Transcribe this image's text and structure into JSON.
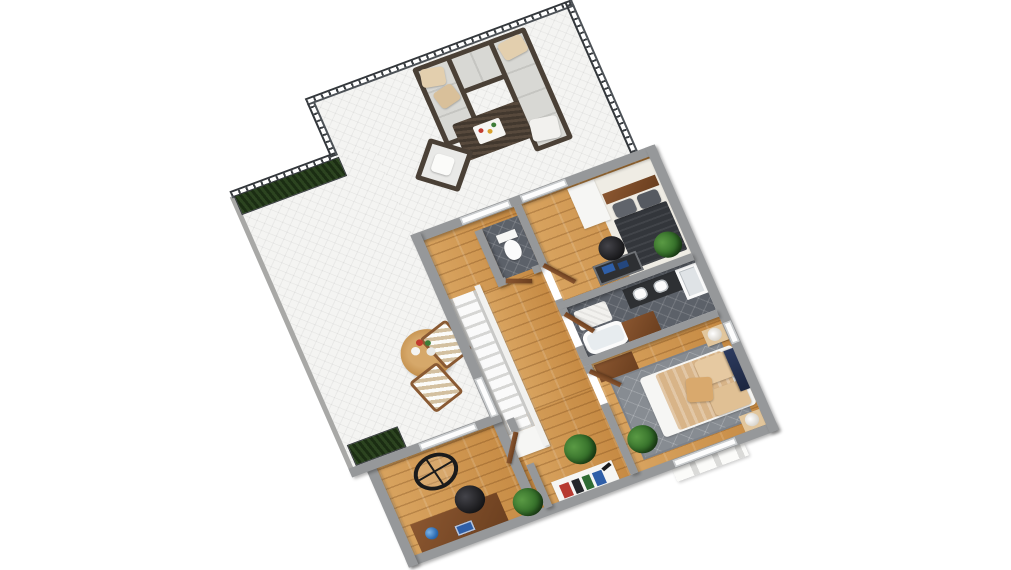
{
  "image": {
    "kind": "3D floor plan rendering, top-down isometric view rotated about 20 degrees",
    "background": "#ffffff",
    "no_text_visible": true
  },
  "terrace": {
    "name": "Terrace",
    "floor": "white herringbone tile",
    "features": [
      "dark metal baluster railing on upper and right edges",
      "hedge planter box along upper-left railing",
      "hedge planter at lower-left corner"
    ],
    "furniture": [
      "dark wicker U-shaped sectional sofa with light gray cushions and beige/white pillows",
      "dark wicker coffee table with white serving tray",
      "dark wicker armchair with white cushion",
      "round wooden dining table with tableware",
      "two striped wooden lounge chairs"
    ]
  },
  "rooms": [
    {
      "name": "Bedroom 1",
      "floor": "wood plank",
      "furniture": [
        "double bed with dark charcoal duvet, gray pillows and wood headboard",
        "white area rug",
        "white wardrobe",
        "dark desk with blue books",
        "black office chair",
        "potted plant"
      ],
      "window": "terrace-facing window"
    },
    {
      "name": "WC",
      "floor": "dark tile",
      "furniture": [
        "white toilet"
      ]
    },
    {
      "name": "Staircase",
      "features": [
        "straight white stairs",
        "white lower landing"
      ]
    },
    {
      "name": "Bathroom",
      "floor": "dark diamond tile",
      "furniture": [
        "white bathtub",
        "white bath mat",
        "wooden cabinet",
        "dark vanity with white sinks",
        "corner shower"
      ]
    },
    {
      "name": "Master Bedroom",
      "floor": "wood plank",
      "furniture": [
        "double bed with striped beige duvet and beige pillows",
        "two beige nightstands with round table lamps",
        "dark blue wall art",
        "gray patterned area rug",
        "wooden dresser",
        "potted plant"
      ],
      "window": "south window with white exterior sills and east window"
    },
    {
      "name": "Home Office",
      "floor": "wood plank",
      "furniture": [
        "wooden desk with globe and blue laptop",
        "black office chair",
        "round black hoop chair",
        "potted plant"
      ]
    },
    {
      "name": "Hallway",
      "floor": "wood plank",
      "furniture": [
        "white bookshelf with red, black, green and blue books and black ornament",
        "potted plants",
        "open wooden doors"
      ]
    }
  ],
  "palette": {
    "walls": "#96989a",
    "white_walls": "#f1f1ef",
    "wood_floor": "#cf9a55",
    "terrace_tile": "#f4f4f2",
    "bath_tile": "#5c6169",
    "railing": "#3a3e42",
    "hedge": "#2c4420",
    "sofa_frame": "#4a4036",
    "sofa_cushion": "#d8d8d4",
    "beige_pillow": "#e3cfae",
    "dark_bed": "#33363b",
    "beige_bed": "#d8b488",
    "plant": "#35702a",
    "door_wood": "#7b4b27",
    "wall_art": "#2c3a5e",
    "rug_gray": "#878c92",
    "rug_white": "#efece4"
  }
}
